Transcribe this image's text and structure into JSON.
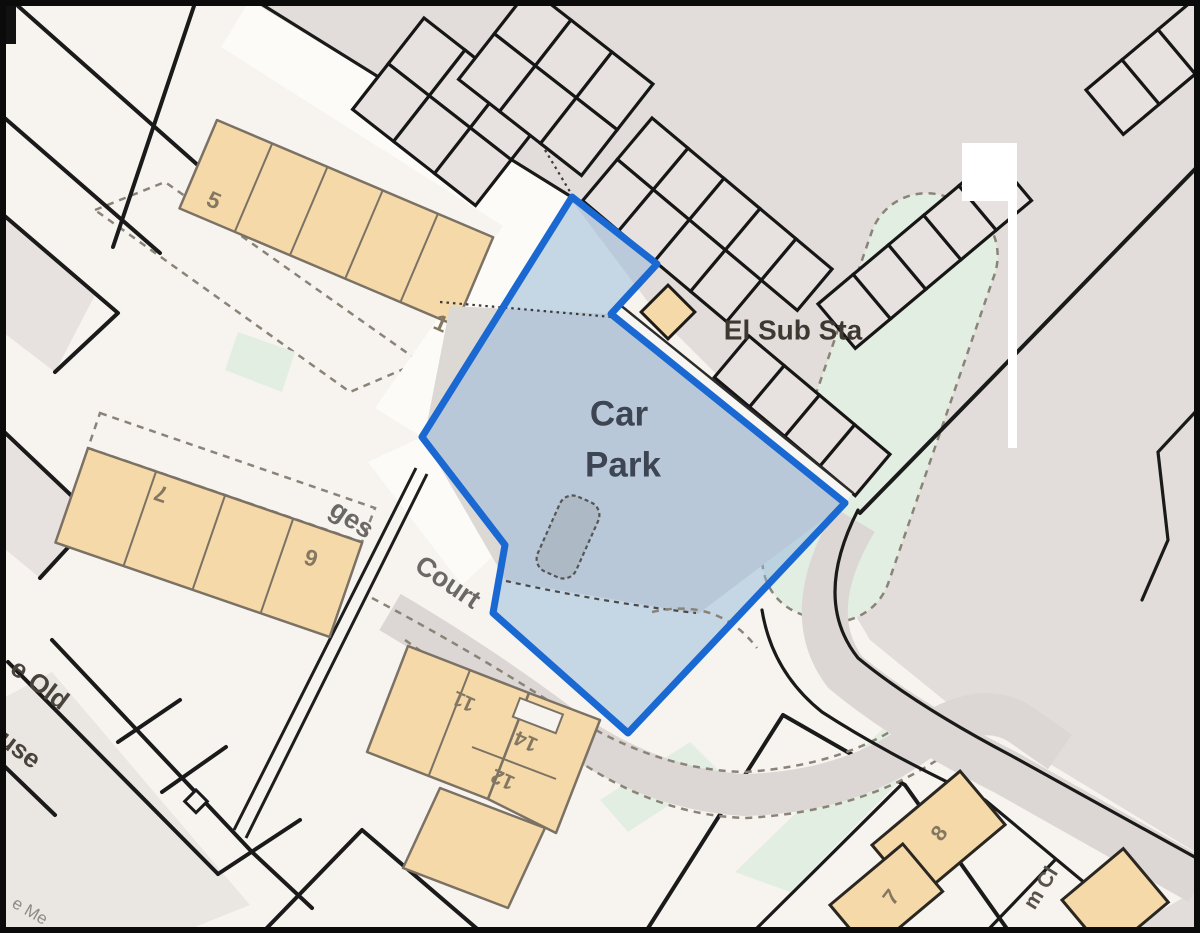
{
  "map": {
    "type": "planning-site-location-plan",
    "site_boundary": {
      "area_label": "Car Park",
      "outline_color": "#1a68d2",
      "fill_tint": "#93b8dc"
    },
    "colors": {
      "background": "#f7f4ef",
      "paved_gray": "#e2ddda",
      "building_fill": "#f6d9a8",
      "building_outline": "#7b7265",
      "green_space": "#e2eee1",
      "line_black": "#1a1a1a",
      "street_text": "#6b6965",
      "plot_number_text": "#847862",
      "place_text": "#3e3831",
      "site_text": "#3d4553"
    },
    "labels": [
      {
        "name": "car-park-line-1",
        "text": "Car",
        "x": 619,
        "y": 414,
        "size": 35,
        "weight": 700,
        "color": "#3d4553",
        "rotate": 0
      },
      {
        "name": "car-park-line-2",
        "text": "Park",
        "x": 623,
        "y": 465,
        "size": 35,
        "weight": 700,
        "color": "#3d4553",
        "rotate": 0
      },
      {
        "name": "el-sub-sta",
        "text": "El Sub Sta",
        "x": 793,
        "y": 330,
        "size": 28,
        "weight": 700,
        "color": "#3e3831",
        "rotate": 0
      },
      {
        "name": "plot-5",
        "text": "5",
        "x": 214,
        "y": 200,
        "size": 23,
        "weight": 700,
        "color": "#847862",
        "rotate": 24
      },
      {
        "name": "plot-1",
        "text": "1",
        "x": 441,
        "y": 323,
        "size": 23,
        "weight": 700,
        "color": "#847862",
        "rotate": 24
      },
      {
        "name": "plot-7-west",
        "text": "7",
        "x": 161,
        "y": 494,
        "size": 23,
        "weight": 700,
        "color": "#847862",
        "rotate": 199
      },
      {
        "name": "plot-6",
        "text": "6",
        "x": 311,
        "y": 558,
        "size": 23,
        "weight": 700,
        "color": "#847862",
        "rotate": 199
      },
      {
        "name": "plot-11",
        "text": "11",
        "x": 464,
        "y": 701,
        "size": 21,
        "weight": 700,
        "color": "#847862",
        "rotate": 204
      },
      {
        "name": "plot-14",
        "text": "14",
        "x": 526,
        "y": 741,
        "size": 21,
        "weight": 700,
        "color": "#847862",
        "rotate": 204
      },
      {
        "name": "plot-12",
        "text": "12",
        "x": 503,
        "y": 779,
        "size": 21,
        "weight": 700,
        "color": "#847862",
        "rotate": 204
      },
      {
        "name": "plot-8",
        "text": "8",
        "x": 939,
        "y": 833,
        "size": 22,
        "weight": 700,
        "color": "#847862",
        "rotate": -52
      },
      {
        "name": "plot-7-south",
        "text": "7",
        "x": 891,
        "y": 897,
        "size": 22,
        "weight": 700,
        "color": "#847862",
        "rotate": -52
      },
      {
        "name": "street-court",
        "text": "Court",
        "x": 448,
        "y": 582,
        "size": 27,
        "weight": 600,
        "color": "#6b6965",
        "rotate": 34
      },
      {
        "name": "street-ges-fragment",
        "text": "ges",
        "x": 352,
        "y": 519,
        "size": 27,
        "weight": 600,
        "color": "#6b6965",
        "rotate": 34
      },
      {
        "name": "building-e-old-fragment",
        "text": "e Old",
        "x": 40,
        "y": 684,
        "size": 26,
        "weight": 700,
        "color": "#49433b",
        "rotate": 37
      },
      {
        "name": "building-use-fragment",
        "text": "use",
        "x": 20,
        "y": 749,
        "size": 26,
        "weight": 700,
        "color": "#49433b",
        "rotate": 37
      },
      {
        "name": "street-m-cl-fragment",
        "text": "m Cl",
        "x": 1041,
        "y": 888,
        "size": 21,
        "weight": 600,
        "color": "#57524a",
        "rotate": -58
      },
      {
        "name": "label-e-me-fragment",
        "text": "e Me",
        "x": 30,
        "y": 911,
        "size": 17,
        "weight": 400,
        "color": "#8d8a84",
        "rotate": 30
      }
    ]
  }
}
